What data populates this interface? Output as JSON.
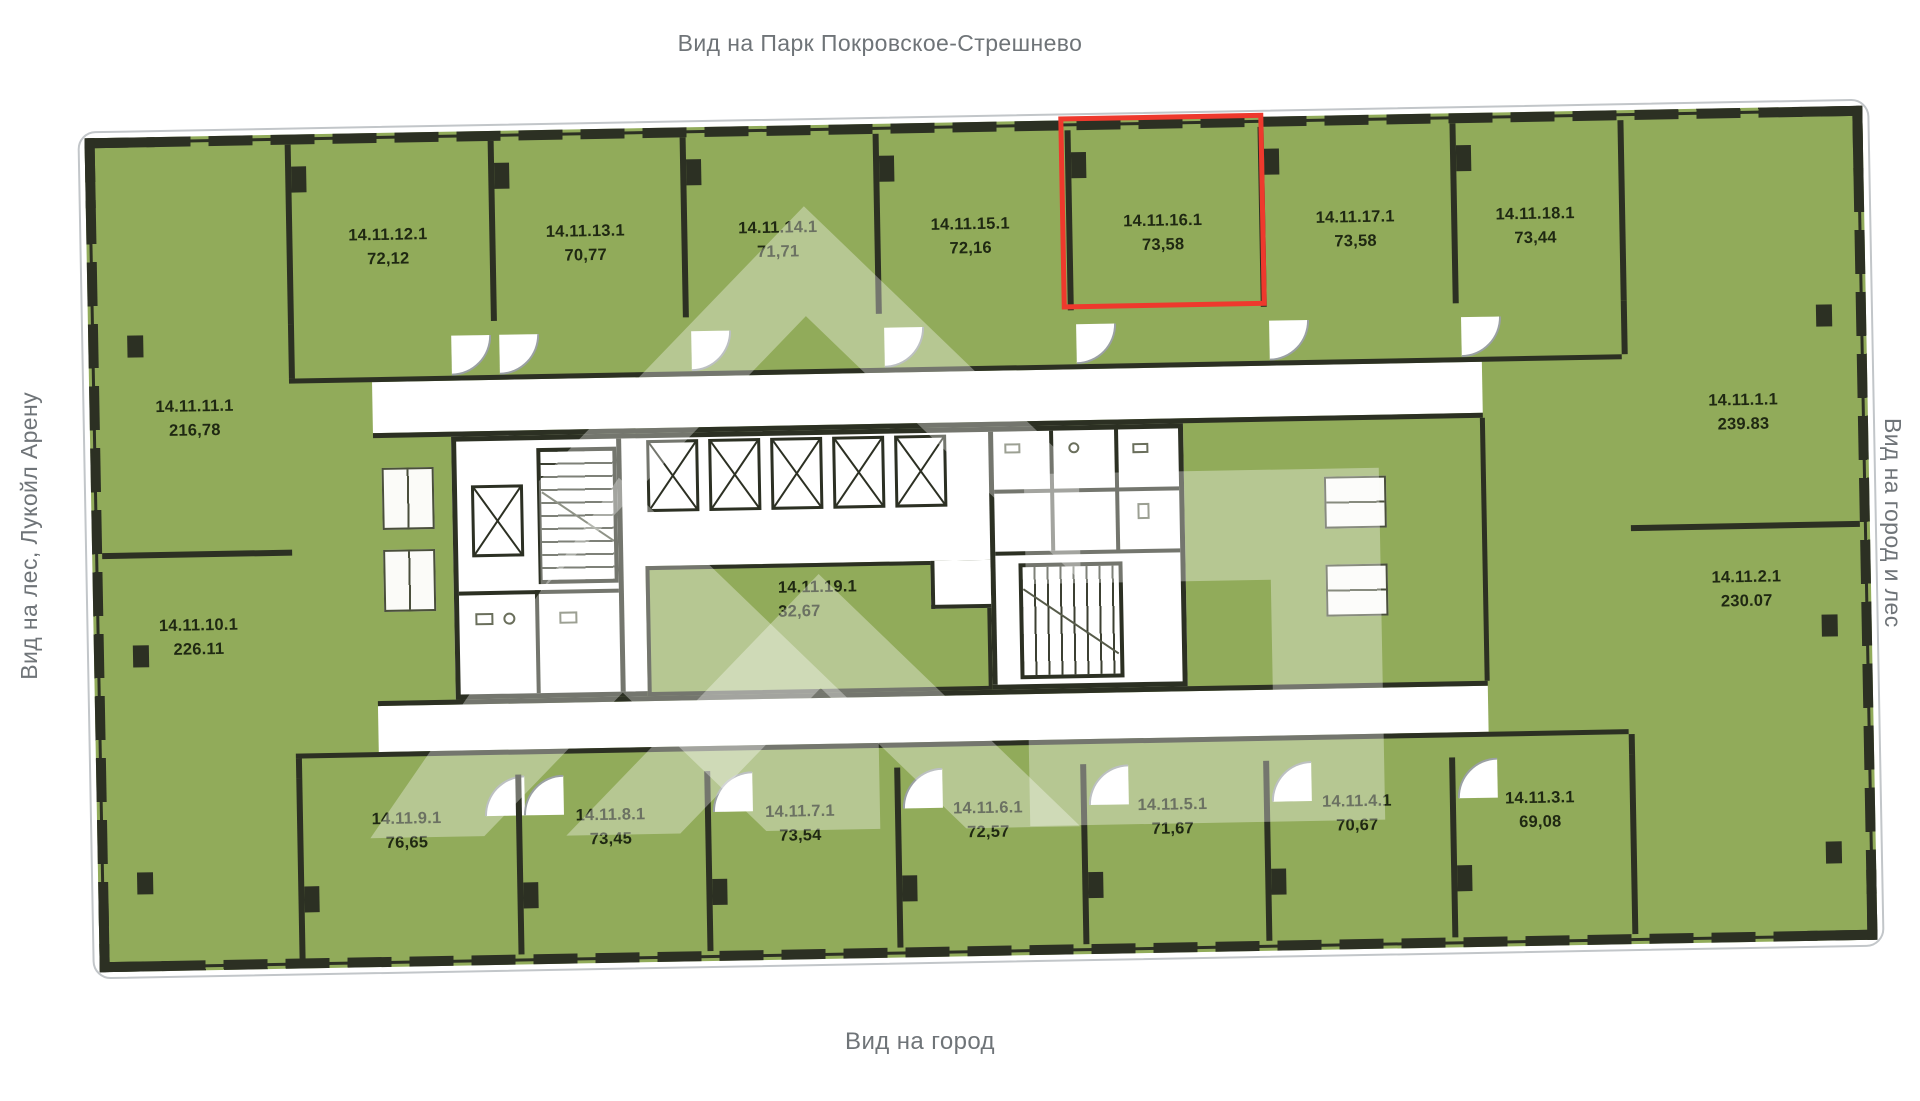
{
  "views": {
    "top": "Вид на Парк Покровское-Стрешнево",
    "bottom": "Вид на город",
    "left": "Вид на лес, Лукойл Арену",
    "right": "Вид на город и лес"
  },
  "highlight": {
    "unit_id": "14.11.16.1",
    "border_color": "#ee392d"
  },
  "colors": {
    "unit_fill": "#91ab5a",
    "wall": "#2c3023",
    "label_text": "#1f2812",
    "view_label_text": "#6f7478",
    "highlight_red": "#ee392d",
    "corridor_white": "#ffffff"
  },
  "units": {
    "top_row": [
      {
        "id": "14.11.12.1",
        "area": "72,12"
      },
      {
        "id": "14.11.13.1",
        "area": "70,77"
      },
      {
        "id": "14.11.14.1",
        "area": "71,71"
      },
      {
        "id": "14.11.15.1",
        "area": "72,16"
      },
      {
        "id": "14.11.16.1",
        "area": "73,58"
      },
      {
        "id": "14.11.17.1",
        "area": "73,58"
      },
      {
        "id": "14.11.18.1",
        "area": "73,44"
      }
    ],
    "left_column": [
      {
        "id": "14.11.11.1",
        "area": "216,78"
      },
      {
        "id": "14.11.10.1",
        "area": "226.11"
      }
    ],
    "right_column": [
      {
        "id": "14.11.1.1",
        "area": "239.83"
      },
      {
        "id": "14.11.2.1",
        "area": "230.07"
      }
    ],
    "bottom_row": [
      {
        "id": "14.11.9.1",
        "area": "76,65"
      },
      {
        "id": "14.11.8.1",
        "area": "73,45"
      },
      {
        "id": "14.11.7.1",
        "area": "73,54"
      },
      {
        "id": "14.11.6.1",
        "area": "72,57"
      },
      {
        "id": "14.11.5.1",
        "area": "71,67"
      },
      {
        "id": "14.11.4.1",
        "area": "70,67"
      },
      {
        "id": "14.11.3.1",
        "area": "69,08"
      }
    ],
    "center": [
      {
        "id": "14.11.19.1",
        "area": "32,67"
      }
    ]
  }
}
